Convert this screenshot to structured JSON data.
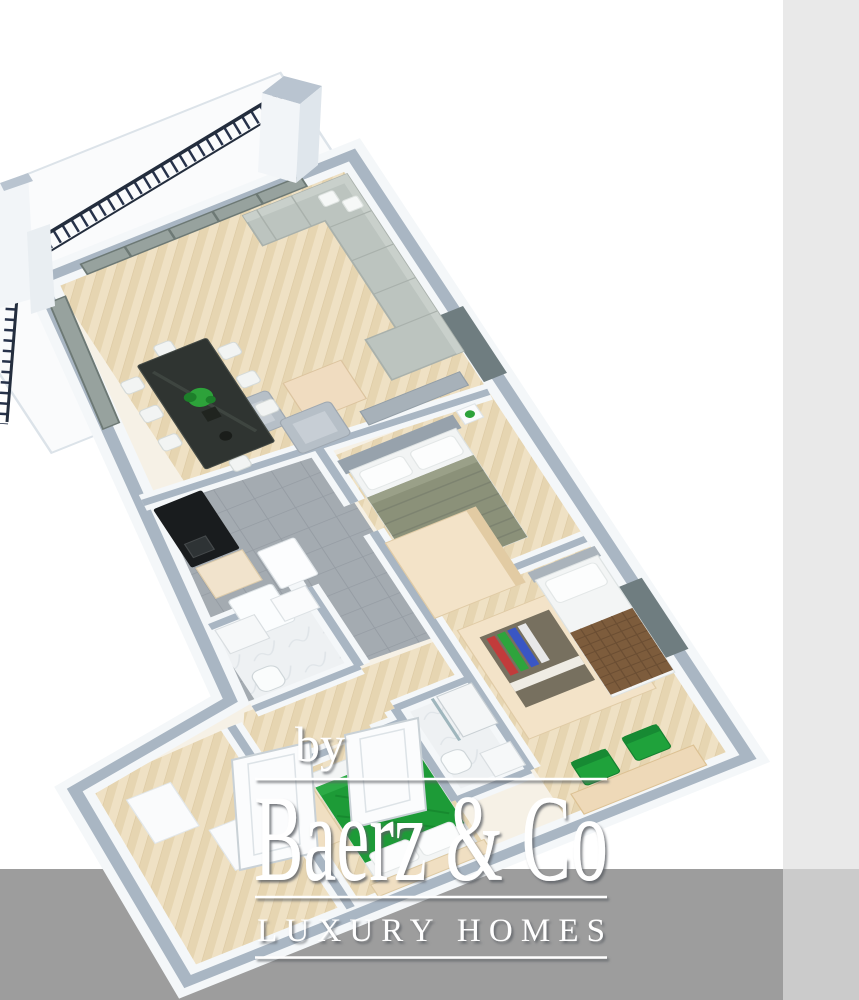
{
  "page": {
    "background_color": "#ffffff",
    "right_panel_color": "#e9e9e9",
    "bottom_band_color": "#9d9d9d",
    "bottom_right_block_color": "#cbcbcb"
  },
  "watermark": {
    "prefix": "by",
    "brand": "Baerz & Co",
    "tagline": "LUXURY HOMES",
    "text_color": "#ffffff"
  },
  "floorplan": {
    "type": "3d-isometric-floor-plan",
    "rooms": [
      "balcony",
      "living-room",
      "dining-area",
      "kitchen",
      "bathroom-1",
      "master-bedroom",
      "dressing-area",
      "bedroom-2",
      "bathroom-2",
      "bedroom-3",
      "entrance-hall"
    ],
    "palette": {
      "wall_top": "#a9b6c3",
      "wall_face": "#f4f7f9",
      "wood_floor": "#efe1c4",
      "tile_floor": "#a4abb1",
      "marble_floor": "#eef1f3",
      "sofa": "#bcc4bf",
      "wood_furniture": "#f0dcc0",
      "dining_glass": "#2f3431",
      "bed_olive": "#8b9179",
      "bed_brown": "#7d5c3c",
      "bed_green": "#1d9b37",
      "chair_green": "#1fa23b",
      "plant_green": "#2da23a",
      "railing": "#27324a",
      "window_glass": "#97a29e"
    }
  }
}
